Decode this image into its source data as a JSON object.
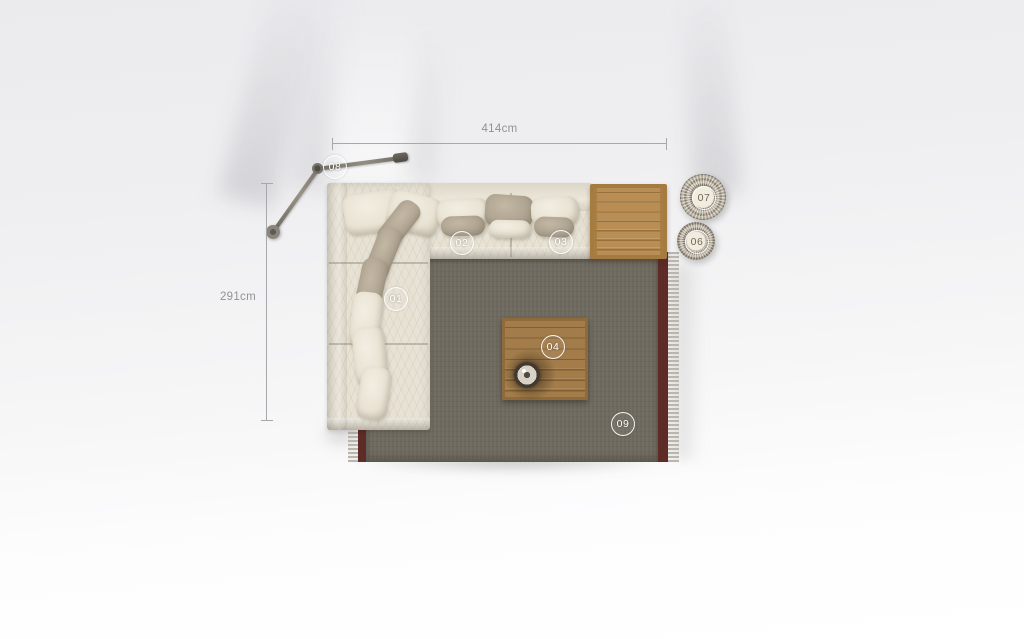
{
  "dimensions": {
    "width": "414cm",
    "height": "291cm"
  },
  "markers": {
    "m01": "01",
    "m02": "02",
    "m03": "03",
    "m04": "04",
    "m06": "06",
    "m07": "07",
    "m08": "08",
    "m09": "09"
  },
  "colors": {
    "background": "#f1f2f3",
    "rug_field": "#6e695e",
    "rug_border": "#5e2b26",
    "rug_fringe": "#b7b3aa",
    "sofa_fabric": "#e7e2d4",
    "pillow_taupe": "#b0a492",
    "pillow_cream": "#ece6d8",
    "side_table_wood": "#b1874d",
    "coffee_table_wood": "#9c7544",
    "basket_weave": "#978d7b",
    "dimension_line": "#a6a9ab",
    "dimension_text": "#8f9396",
    "marker_ring": "#ffffff"
  }
}
